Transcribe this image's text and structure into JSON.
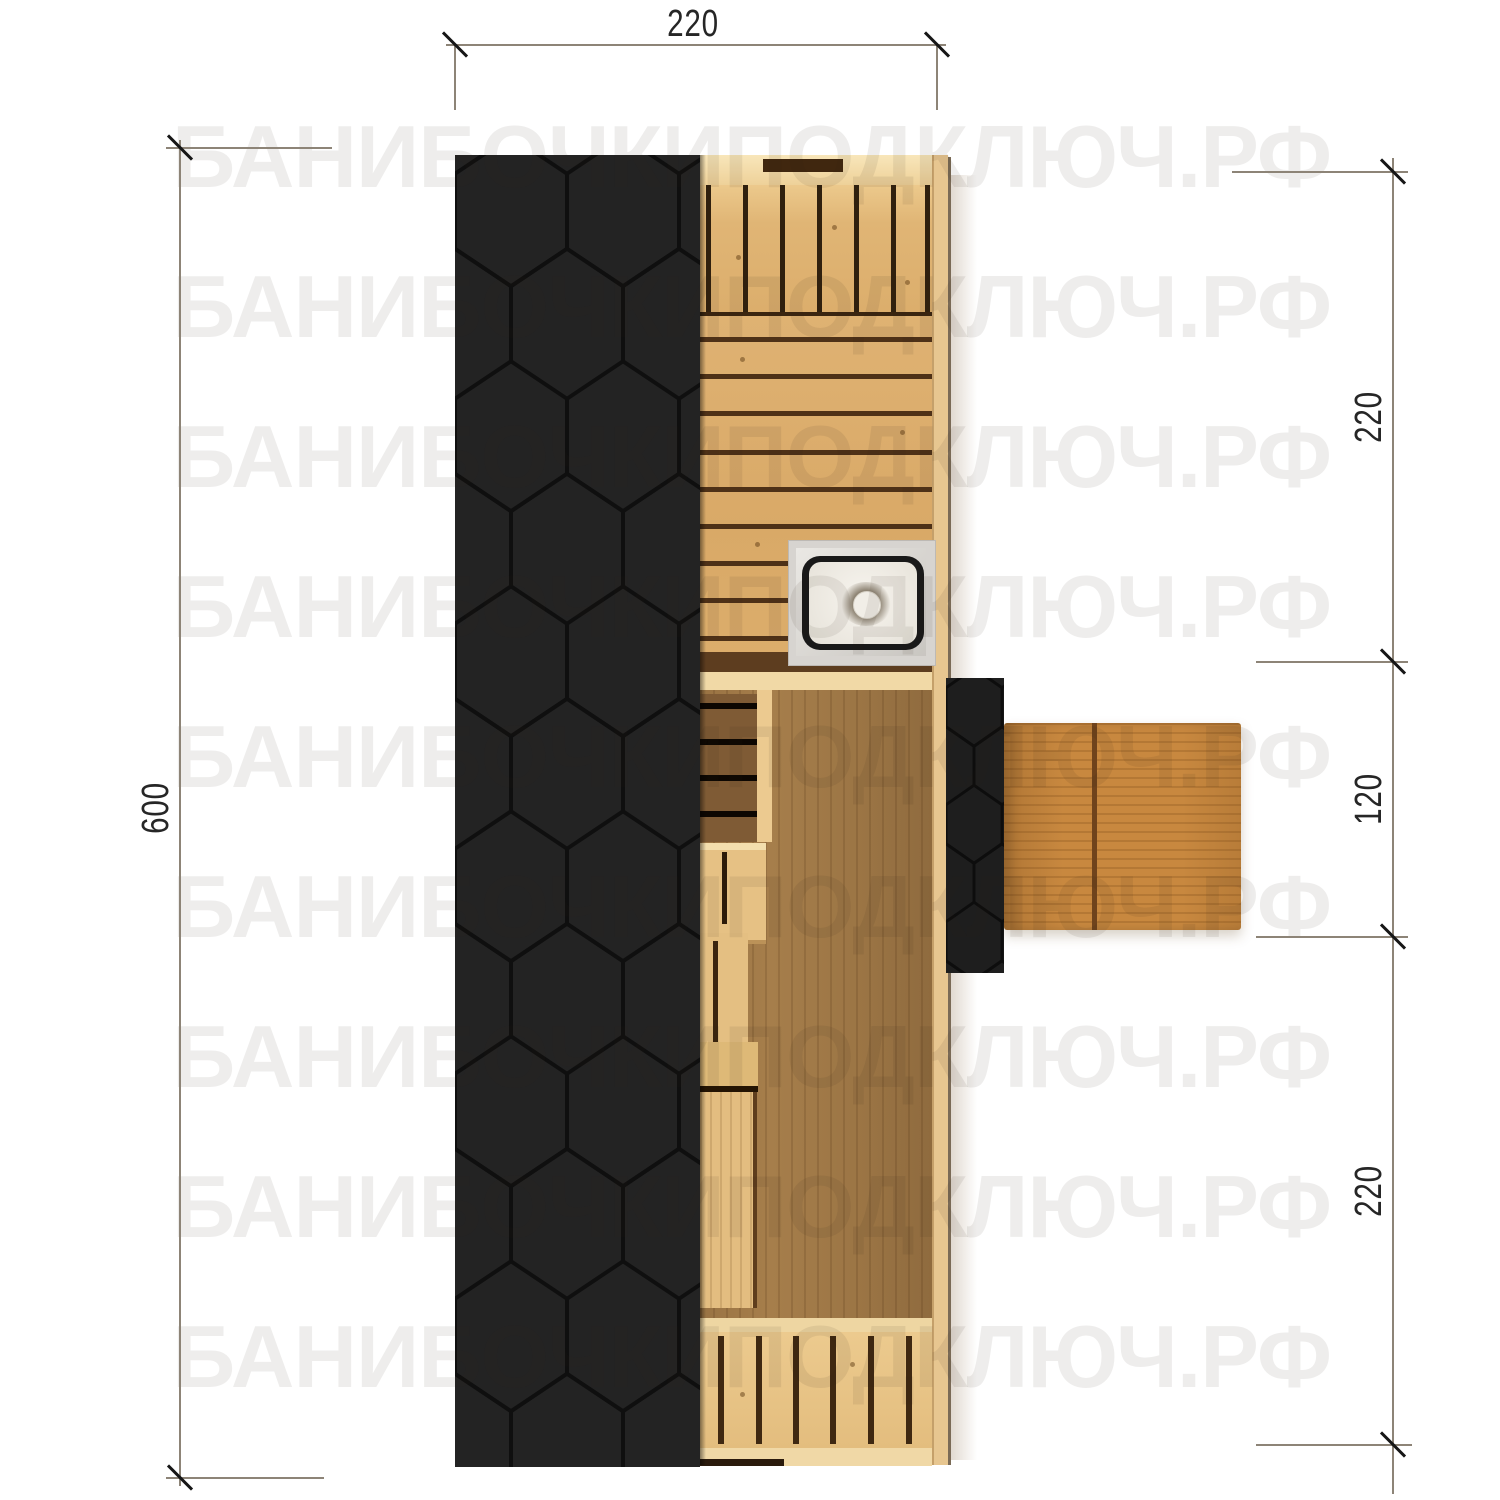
{
  "watermark": {
    "text": "БАНИБОЧКИПОДКЛЮЧ.РФ"
  },
  "dimensions": {
    "top_width": {
      "label": "220"
    },
    "left_height": {
      "label": "600"
    },
    "right_top": {
      "label": "220"
    },
    "right_middle": {
      "label": "120"
    },
    "right_bottom": {
      "label": "220"
    }
  },
  "palette": {
    "roof_black": "#232323",
    "hex_outline": "#0f0f0f",
    "floor_plank": "#dcae6c",
    "entry_floor": "#a67e4b",
    "landing_wood": "#c8883f",
    "dim_line": "#8d8477",
    "watermark_gray": "#ebebeb"
  }
}
